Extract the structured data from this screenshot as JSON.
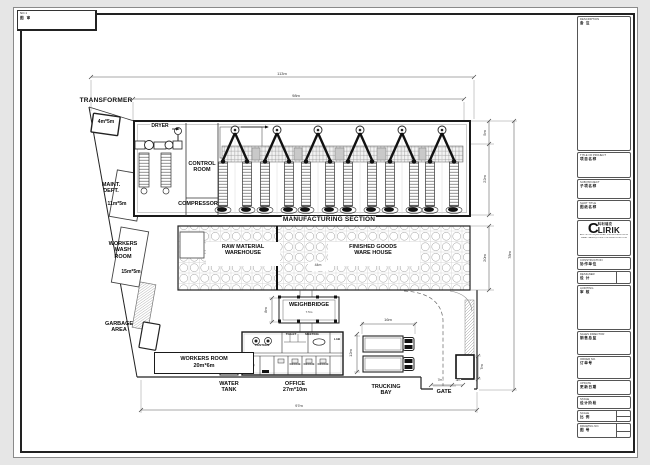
{
  "colors": {
    "ink": "#1a1a1a",
    "paper": "#ffffff",
    "background": "#e6e6e6",
    "hatch": "#9a9a9a"
  },
  "stamp": {
    "line1": "NO.1",
    "line2": "图 审"
  },
  "plan": {
    "transformer": "TRANSFORMER",
    "transformer_size": "4m*5m",
    "dryer": "DRYER",
    "control_room": [
      "CONTROL",
      "ROOM"
    ],
    "compressor": "COMPRESSOR",
    "manufacturing": "MANUFACTURING SECTION",
    "raw_material": [
      "RAW MATERIAL",
      "WAREHOUSE"
    ],
    "finished_goods": [
      "FINISHED GOODS",
      "WARE HOUSE"
    ],
    "maint": [
      "MAINT.",
      "DEPT."
    ],
    "maint_size": "11m*5m",
    "wash": [
      "WORKERS",
      "WASH",
      "ROOM"
    ],
    "wash_size": "15m*5m",
    "garbage": [
      "GARBAGE",
      "AREA"
    ],
    "workers_room": "WORKERS ROOM",
    "workers_room_size": "20m*6m",
    "water_tank": [
      "WATER",
      "TANK"
    ],
    "office": "OFFICE",
    "office_size": "27m*10m",
    "weighbridge": "WEIGHBRIDGE",
    "trucking": [
      "TRUCKING",
      "BAY"
    ],
    "gate": "GATE"
  },
  "office_detail": {
    "canteen": "CANTEEN",
    "toilet": "TOILET",
    "meeting": "MEETING",
    "lab": "LAB",
    "office1": "OFFICE",
    "office2": "OFFICE",
    "office3": "OFFICE"
  },
  "dims": {
    "top_outer": "113m",
    "top_inner": "98m",
    "bottom": "97m",
    "right_overall": "78m",
    "hall_top": "5m",
    "hall_height": "22m",
    "warehouse_height": "20m",
    "warehouse_width": "44m",
    "weighbridge_len": "8m",
    "weighbridge_w": "7.5m",
    "trucking_width": "16m",
    "trucking_height": "12m",
    "gate_left": "7m",
    "gate_width": "3m",
    "guard_height": "7m"
  },
  "titleblock": {
    "description": {
      "label": "DESCRIPTION",
      "cn": "备 注"
    },
    "project": {
      "label": "TITLE OF PROJECT",
      "cn": "项目名称"
    },
    "sub_project": {
      "label": "SUB PROJECT",
      "cn": "子项名称"
    },
    "sheet_title": {
      "label": "SHOT TITLE",
      "cn": "图纸名称"
    },
    "logo": {
      "c": "C",
      "rest": "LIRIK",
      "cn": "科利瑞克",
      "addr1": "ADD: NO.19 FUQING ROAD, PUDONG NEW DISTRICT, SHANGHAI, CHINA",
      "addr2": "EMAIL: SALES@CLIRIK.COM   WWW.CLIRIK.COM"
    },
    "construction": {
      "label": "CONSTRUCTION",
      "cn": "协作单位"
    },
    "designer": {
      "label": "DESIGNER",
      "cn": "设 计"
    },
    "auditing": {
      "label": "AUDITING",
      "cn": "审 核"
    },
    "sales": {
      "label": "SALES DIRECTOR",
      "cn": "销售总监"
    },
    "order": {
      "label": "ORDER NO.",
      "cn": "订单号"
    },
    "update": {
      "label": "UPDATE",
      "cn": "更新日期"
    },
    "stage": {
      "label": "STAGE",
      "cn": "设计阶段"
    },
    "scale": {
      "label": "SCALE",
      "cn": "比 例"
    },
    "drawing_no": {
      "label": "DRAWING NO.",
      "cn": "图 号"
    }
  }
}
